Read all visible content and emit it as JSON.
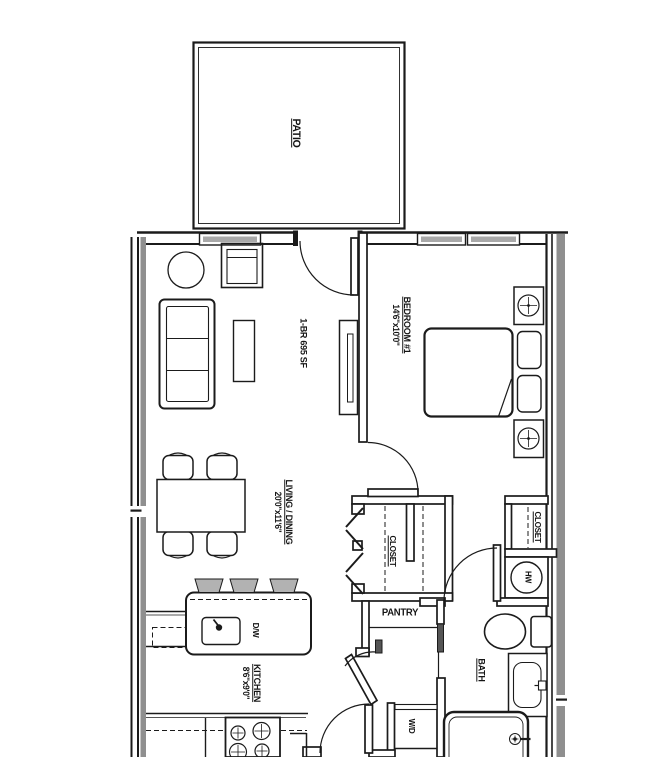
{
  "plan": {
    "unit_label": "1-BR 695 SF",
    "rooms": {
      "patio": {
        "name": "PATIO"
      },
      "bedroom1": {
        "name": "BEDROOM #1",
        "dims": "14'6\"x10'0\""
      },
      "living_dining": {
        "name": "LIVING / DINING",
        "dims": "20'0\"x11'6\""
      },
      "kitchen": {
        "name": "KITCHEN",
        "dims": "8'6\"x9'0\""
      },
      "bath": {
        "name": "BATH"
      },
      "pantry": {
        "name": "PANTRY"
      },
      "closet_main": {
        "name": "CLOSET"
      },
      "closet_bedroom": {
        "name": "CLOSET"
      }
    },
    "appliances": {
      "water_heater": "HW",
      "washer_dryer": "W/D",
      "dishwasher": "D/W"
    },
    "colors": {
      "line": "#1b1b1b",
      "party_wall_gray": "#8f8f8f",
      "stool_gray": "#b2b2b2",
      "window_gray": "#a9a9a9",
      "door_panel_dark": "#555555",
      "background": "#ffffff"
    }
  }
}
